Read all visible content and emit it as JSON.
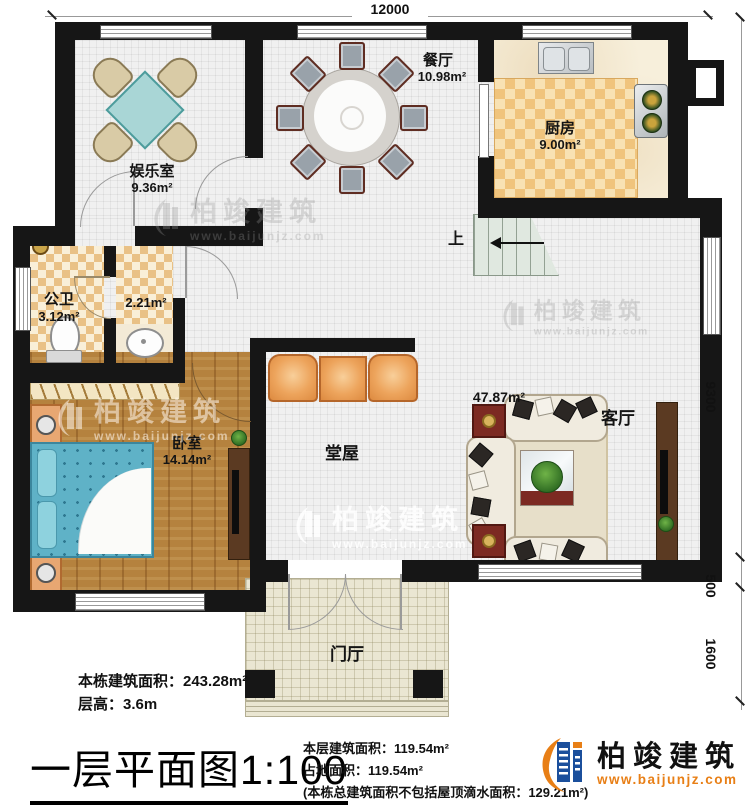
{
  "dimensions": {
    "top": "12000",
    "right_top": "9300",
    "right_mid": "500",
    "right_bottom": "1600"
  },
  "rooms": {
    "entertainment": {
      "name": "娱乐室",
      "area": "9.36m²"
    },
    "dining": {
      "name": "餐厅",
      "area": "10.98m²"
    },
    "kitchen": {
      "name": "厨房",
      "area": "9.00m²"
    },
    "bathroom": {
      "name": "公卫",
      "area": "3.12m²"
    },
    "storage": {
      "area": "2.21m²"
    },
    "bedroom": {
      "name": "卧室",
      "area": "14.14m²"
    },
    "hall": {
      "name": "堂屋"
    },
    "living": {
      "name": "客厅",
      "area": "47.87m²"
    },
    "foyer": {
      "name": "门厅"
    },
    "stairs": {
      "up_label": "上"
    }
  },
  "info_left": {
    "line1": "本栋建筑面积：243.28m²",
    "line2": "层高：3.6m"
  },
  "title": "一层平面图1:100",
  "info_bottom": {
    "line1": "本层建筑面积：119.54m²",
    "line2": "占地面积：119.54m²",
    "line3": "(本栋总建筑面积不包括屋顶滴水面积：129.21m²)"
  },
  "brand": {
    "name": "柏竣建筑",
    "url": "www.baijunjz.com"
  },
  "watermark": {
    "name": "柏竣建筑",
    "url": "www.baijunjz.com"
  },
  "colors": {
    "brand_blue": "#1b4f9c",
    "brand_orange": "#e87f16",
    "wall": "#161616"
  }
}
